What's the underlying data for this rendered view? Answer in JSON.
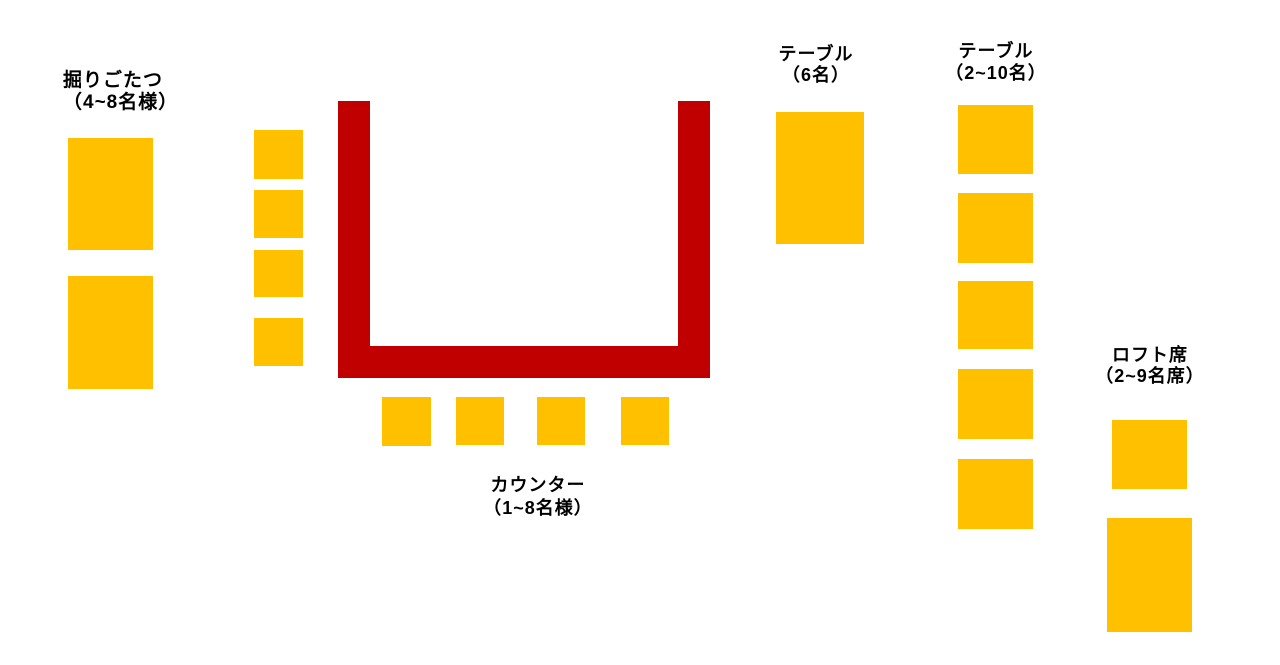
{
  "colors": {
    "background": "#FFFFFF",
    "seat_fill": "#FFC000",
    "counter_fill": "#C00000",
    "label_text": "#000000"
  },
  "labels": {
    "horigotatsu": {
      "line1": "掘りごたつ",
      "line2": "（4~8名様）"
    },
    "counter": {
      "line1": "カウンター",
      "line2": "（1~8名様）"
    },
    "table6": {
      "line1": "テーブル",
      "line2": "（6名）"
    },
    "table2_10": {
      "line1": "テーブル",
      "line2": "（2~10名）"
    },
    "loft": {
      "line1": "ロフト席",
      "line2": "（2~9名席）"
    }
  },
  "seat_groups": [
    {
      "name": "horigotatsu-table",
      "rects": [
        [
          68,
          138,
          85,
          112
        ],
        [
          68,
          276,
          85,
          113
        ]
      ]
    },
    {
      "name": "horigotatsu-side-seat",
      "rects": [
        [
          254,
          130,
          49,
          49
        ],
        [
          254,
          190,
          49,
          48
        ],
        [
          254,
          250,
          49,
          47
        ],
        [
          254,
          318,
          49,
          48
        ]
      ]
    },
    {
      "name": "counter-seat",
      "rects": [
        [
          382,
          397,
          49,
          49
        ],
        [
          456,
          397,
          48,
          48
        ],
        [
          537,
          397,
          48,
          48
        ],
        [
          621,
          397,
          48,
          48
        ]
      ]
    },
    {
      "name": "table6-table",
      "rects": [
        [
          776,
          112,
          88,
          132
        ]
      ]
    },
    {
      "name": "table2-10-table",
      "rects": [
        [
          958,
          105,
          75,
          69
        ],
        [
          958,
          193,
          75,
          70
        ],
        [
          958,
          281,
          75,
          68
        ],
        [
          958,
          369,
          75,
          70
        ],
        [
          958,
          459,
          75,
          70
        ]
      ]
    },
    {
      "name": "loft-table",
      "rects": [
        [
          1112,
          420,
          75,
          69
        ],
        [
          1107,
          518,
          85,
          114
        ]
      ]
    }
  ],
  "counter_shape": {
    "name": "counter-u-shape",
    "bars": [
      [
        338,
        101,
        32,
        277
      ],
      [
        678,
        101,
        32,
        277
      ],
      [
        338,
        346,
        372,
        32
      ]
    ]
  }
}
